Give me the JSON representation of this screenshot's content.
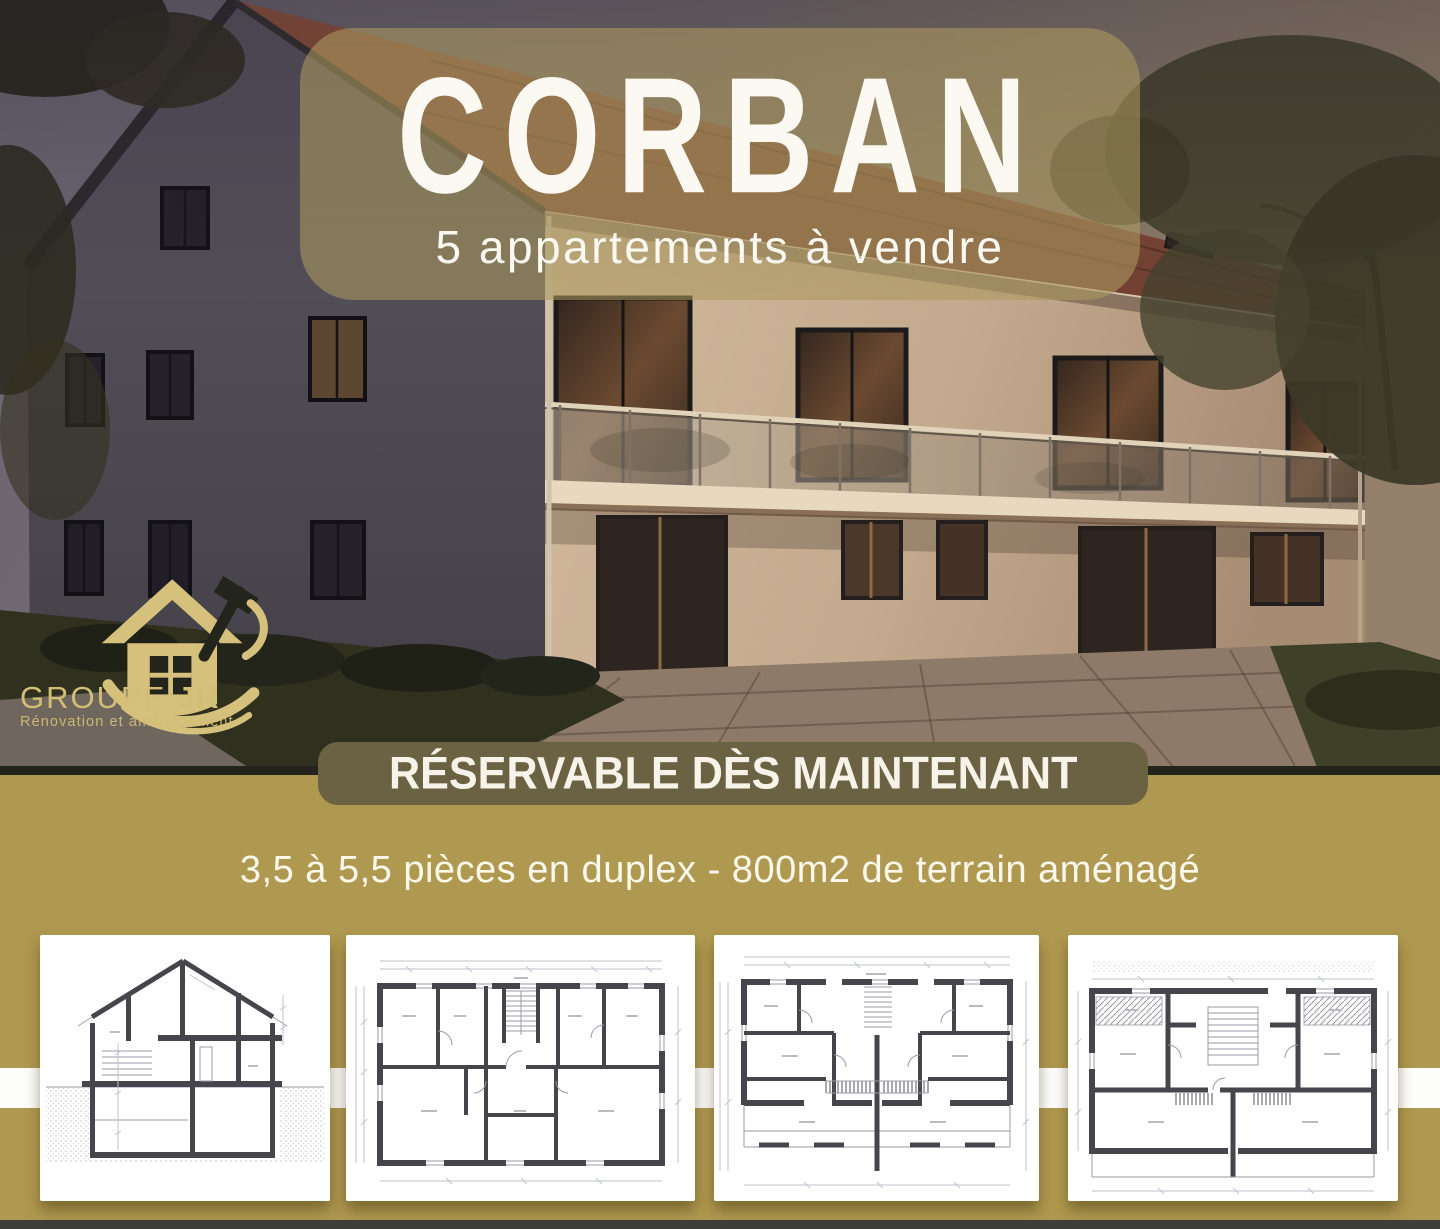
{
  "hero": {
    "title": "CORBAN",
    "subtitle": "5 appartements à vendre"
  },
  "logo": {
    "name_part1": "GROUPE",
    "name_part2": "JR",
    "tagline": "Rénovation et aménagement"
  },
  "ribbon": {
    "label": "RÉSERVABLE DÈS MAINTENANT"
  },
  "details": {
    "description": "3,5 à 5,5 pièces en duplex - 800m2 de terrain aménagé"
  },
  "floor_plans": [
    {
      "name": "cross-section"
    },
    {
      "name": "upper-floor-plan"
    },
    {
      "name": "ground-floor-plan"
    },
    {
      "name": "attic-floor-plan"
    }
  ],
  "colors": {
    "gold": "#af9950",
    "ribbon": "#6b6143",
    "overlay": "rgba(173,154,94,0.58)",
    "logo-gold": "#d3be75",
    "text-white": "#fcf9f2",
    "card-bg": "#ffffff",
    "bottom-strip": "#3e3e38"
  }
}
